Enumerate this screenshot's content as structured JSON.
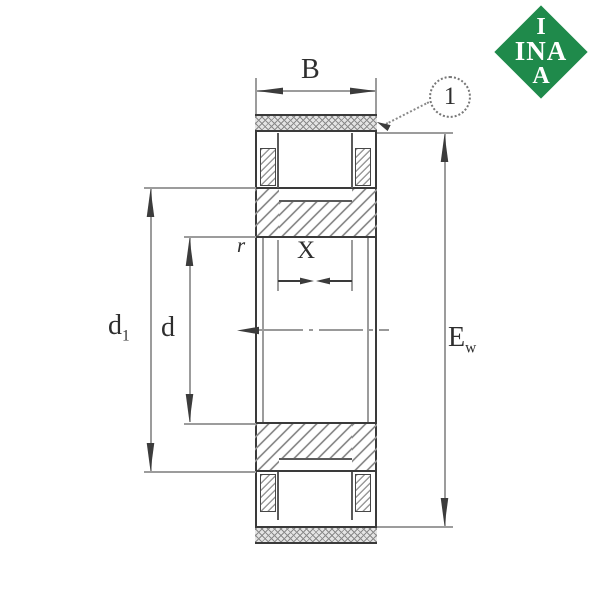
{
  "figure": {
    "type": "bearing-section-technical-drawing",
    "brand": "INA"
  },
  "dimensions": {
    "outer_width": {
      "label": "B"
    },
    "rib_diameter": {
      "label": "d",
      "sub": "1"
    },
    "bore_diameter": {
      "label": "d"
    },
    "raceway_width": {
      "label": "X"
    },
    "chamfer": {
      "label": "r"
    },
    "envelope": {
      "label": "E",
      "sub": "w"
    }
  },
  "callout": {
    "number": "1"
  },
  "logo": {
    "row_top": "I",
    "row_middle": "INA",
    "row_bottom": "A"
  },
  "colors": {
    "logo_green": "#1f8a4b",
    "line_dark": "#3a3a3a",
    "line_dim": "#9c9c9c"
  }
}
